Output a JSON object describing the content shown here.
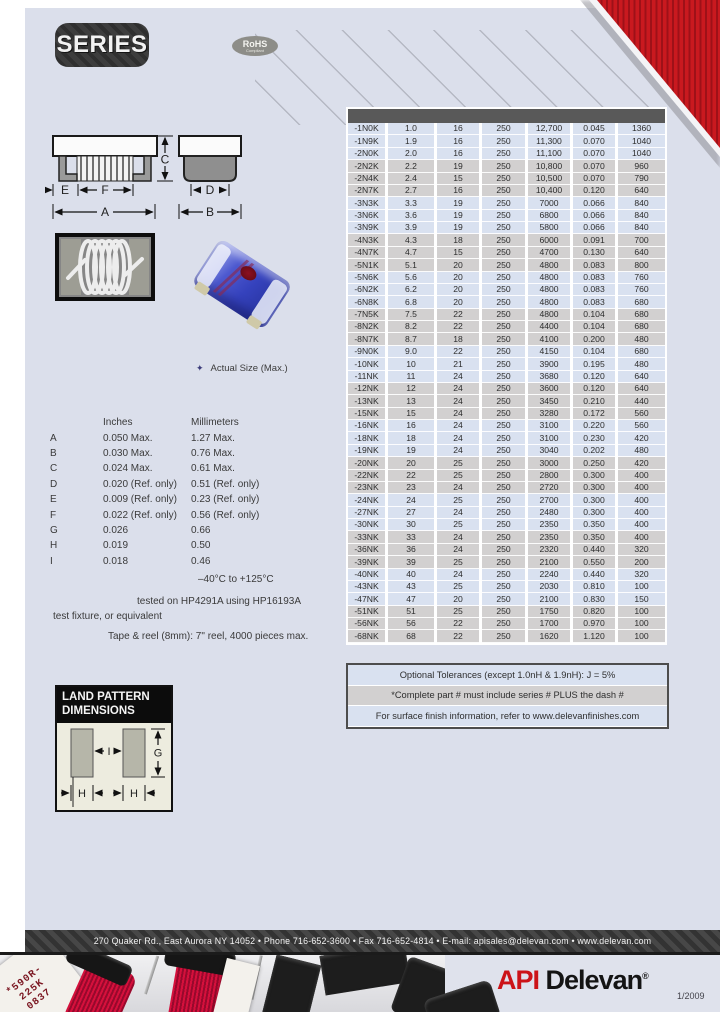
{
  "page": {
    "series_label": "SERIES",
    "rohs_line1": "RoHS",
    "rohs_line2": "Compliant",
    "actual_size_note": "Actual Size (Max.)",
    "date_stamp": "1/2009"
  },
  "drawing": {
    "labels": {
      "a": "A",
      "b": "B",
      "c": "C",
      "d": "D",
      "e": "E",
      "f": "F"
    }
  },
  "dimensions": {
    "col_inches": "Inches",
    "col_mm": "Millimeters",
    "rows": [
      {
        "label": "A",
        "in": "0.050 Max.",
        "mm": "1.27 Max."
      },
      {
        "label": "B",
        "in": "0.030 Max.",
        "mm": "0.76 Max."
      },
      {
        "label": "C",
        "in": "0.024 Max.",
        "mm": "0.61 Max."
      },
      {
        "label": "D",
        "in": "0.020 (Ref. only)",
        "mm": "0.51 (Ref. only)"
      },
      {
        "label": "E",
        "in": "0.009 (Ref. only)",
        "mm": "0.23 (Ref. only)"
      },
      {
        "label": "F",
        "in": "0.022 (Ref. only)",
        "mm": "0.56 (Ref. only)"
      },
      {
        "label": "G",
        "in": "0.026",
        "mm": "0.66"
      },
      {
        "label": "H",
        "in": "0.019",
        "mm": "0.50"
      },
      {
        "label": "I",
        "in": "0.018",
        "mm": "0.46"
      }
    ]
  },
  "specs": {
    "temp_range": "–40°C to +125°C",
    "test_line1": "tested on HP4291A using HP16193A",
    "test_line2": "test fixture, or equivalent",
    "tape_reel": "Tape & reel (8mm): 7\" reel, 4000 pieces max."
  },
  "land_pattern": {
    "title_line1": "LAND PATTERN",
    "title_line2": "DIMENSIONS",
    "labels": {
      "g": "G",
      "i": "I",
      "h": "H"
    }
  },
  "table": {
    "rows": [
      [
        "-1N0K",
        "1.0",
        "16",
        "250",
        "12,700",
        "0.045",
        "1360"
      ],
      [
        "-1N9K",
        "1.9",
        "16",
        "250",
        "11,300",
        "0.070",
        "1040"
      ],
      [
        "-2N0K",
        "2.0",
        "16",
        "250",
        "11,100",
        "0.070",
        "1040"
      ],
      [
        "-2N2K",
        "2.2",
        "19",
        "250",
        "10,800",
        "0.070",
        "960"
      ],
      [
        "-2N4K",
        "2.4",
        "15",
        "250",
        "10,500",
        "0.070",
        "790"
      ],
      [
        "-2N7K",
        "2.7",
        "16",
        "250",
        "10,400",
        "0.120",
        "640"
      ],
      [
        "-3N3K",
        "3.3",
        "19",
        "250",
        "7000",
        "0.066",
        "840"
      ],
      [
        "-3N6K",
        "3.6",
        "19",
        "250",
        "6800",
        "0.066",
        "840"
      ],
      [
        "-3N9K",
        "3.9",
        "19",
        "250",
        "5800",
        "0.066",
        "840"
      ],
      [
        "-4N3K",
        "4.3",
        "18",
        "250",
        "6000",
        "0.091",
        "700"
      ],
      [
        "-4N7K",
        "4.7",
        "15",
        "250",
        "4700",
        "0.130",
        "640"
      ],
      [
        "-5N1K",
        "5.1",
        "20",
        "250",
        "4800",
        "0.083",
        "800"
      ],
      [
        "-5N6K",
        "5.6",
        "20",
        "250",
        "4800",
        "0.083",
        "760"
      ],
      [
        "-6N2K",
        "6.2",
        "20",
        "250",
        "4800",
        "0.083",
        "760"
      ],
      [
        "-6N8K",
        "6.8",
        "20",
        "250",
        "4800",
        "0.083",
        "680"
      ],
      [
        "-7N5K",
        "7.5",
        "22",
        "250",
        "4800",
        "0.104",
        "680"
      ],
      [
        "-8N2K",
        "8.2",
        "22",
        "250",
        "4400",
        "0.104",
        "680"
      ],
      [
        "-8N7K",
        "8.7",
        "18",
        "250",
        "4100",
        "0.200",
        "480"
      ],
      [
        "-9N0K",
        "9.0",
        "22",
        "250",
        "4150",
        "0.104",
        "680"
      ],
      [
        "-10NK",
        "10",
        "21",
        "250",
        "3900",
        "0.195",
        "480"
      ],
      [
        "-11NK",
        "11",
        "24",
        "250",
        "3680",
        "0.120",
        "640"
      ],
      [
        "-12NK",
        "12",
        "24",
        "250",
        "3600",
        "0.120",
        "640"
      ],
      [
        "-13NK",
        "13",
        "24",
        "250",
        "3450",
        "0.210",
        "440"
      ],
      [
        "-15NK",
        "15",
        "24",
        "250",
        "3280",
        "0.172",
        "560"
      ],
      [
        "-16NK",
        "16",
        "24",
        "250",
        "3100",
        "0.220",
        "560"
      ],
      [
        "-18NK",
        "18",
        "24",
        "250",
        "3100",
        "0.230",
        "420"
      ],
      [
        "-19NK",
        "19",
        "24",
        "250",
        "3040",
        "0.202",
        "480"
      ],
      [
        "-20NK",
        "20",
        "25",
        "250",
        "3000",
        "0.250",
        "420"
      ],
      [
        "-22NK",
        "22",
        "25",
        "250",
        "2800",
        "0.300",
        "400"
      ],
      [
        "-23NK",
        "23",
        "24",
        "250",
        "2720",
        "0.300",
        "400"
      ],
      [
        "-24NK",
        "24",
        "25",
        "250",
        "2700",
        "0.300",
        "400"
      ],
      [
        "-27NK",
        "27",
        "24",
        "250",
        "2480",
        "0.300",
        "400"
      ],
      [
        "-30NK",
        "30",
        "25",
        "250",
        "2350",
        "0.350",
        "400"
      ],
      [
        "-33NK",
        "33",
        "24",
        "250",
        "2350",
        "0.350",
        "400"
      ],
      [
        "-36NK",
        "36",
        "24",
        "250",
        "2320",
        "0.440",
        "320"
      ],
      [
        "-39NK",
        "39",
        "25",
        "250",
        "2100",
        "0.550",
        "200"
      ],
      [
        "-40NK",
        "40",
        "24",
        "250",
        "2240",
        "0.440",
        "320"
      ],
      [
        "-43NK",
        "43",
        "25",
        "250",
        "2030",
        "0.810",
        "100"
      ],
      [
        "-47NK",
        "47",
        "20",
        "250",
        "2100",
        "0.830",
        "150"
      ],
      [
        "-51NK",
        "51",
        "25",
        "250",
        "1750",
        "0.820",
        "100"
      ],
      [
        "-56NK",
        "56",
        "22",
        "250",
        "1700",
        "0.970",
        "100"
      ],
      [
        "-68NK",
        "68",
        "22",
        "250",
        "1620",
        "1.120",
        "100"
      ]
    ]
  },
  "notes": [
    "Optional Tolerances (except 1.0nH & 1.9nH):  J = 5%",
    "*Complete part # must include series # PLUS the dash #",
    "For surface finish information, refer to www.delevanfinishes.com"
  ],
  "footer": {
    "address": "270 Quaker Rd., East Aurora NY 14052   •   Phone 716-652-3600   •   Fax 716-652-4814   •   E-mail: apisales@delevan.com   •   www.delevan.com"
  },
  "photo": {
    "labels": [
      "*590R-",
      "225K",
      "0837"
    ]
  },
  "logo": {
    "api": "API",
    "delevan": "Delevan",
    "reg": "®"
  },
  "colors": {
    "accent_red": "#cc1318",
    "page_bg": "#dbdfeb",
    "row_blue": "#d9e1f0",
    "row_gray": "#d2d0d0"
  }
}
